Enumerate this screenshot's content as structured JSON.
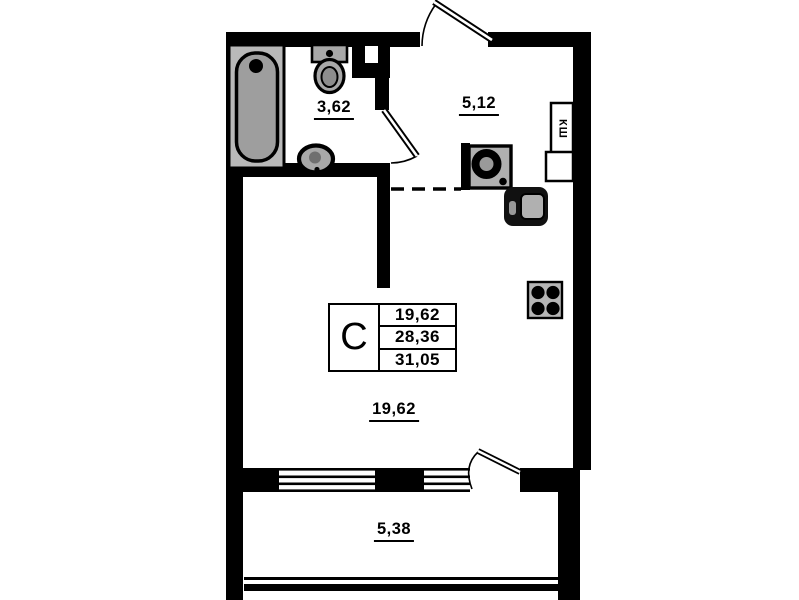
{
  "floor_plan": {
    "rooms": [
      {
        "name": "bathroom",
        "area_label": "3,62"
      },
      {
        "name": "kitchen-hall",
        "area_label": "5,12"
      },
      {
        "name": "living-room",
        "area_label": "19,62"
      },
      {
        "name": "balcony",
        "area_label": "5,38"
      }
    ],
    "info_table": {
      "section_label": "C",
      "values": [
        "19,62",
        "28,36",
        "31,05"
      ]
    },
    "duct_label": "КШ",
    "fixtures": [
      "bathtub",
      "toilet",
      "washbasin",
      "kitchen-sink",
      "washer-unit",
      "stove"
    ],
    "colors": {
      "wall": "#000000",
      "background": "#ffffff",
      "fixture": "#a8a8a8",
      "fixture_light": "#b9b9b9",
      "fixture_dark": "#111111"
    }
  }
}
